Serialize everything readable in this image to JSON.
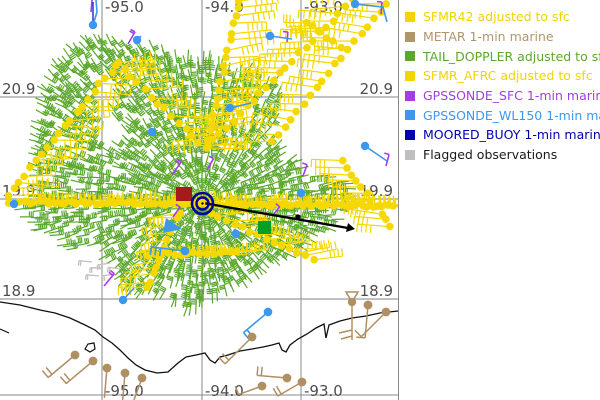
{
  "map": {
    "width": 398,
    "height": 400,
    "grid_color": "#9c9c9c",
    "border_color": "#8a8a8a",
    "label_color": "#4d4d4d",
    "coast_color": "#111111",
    "lon_lines": [
      {
        "label": "-95.0",
        "x": 102
      },
      {
        "label": "-94.0",
        "x": 202
      },
      {
        "label": "-93.0",
        "x": 301
      }
    ],
    "lat_lines": [
      {
        "label": "20.9",
        "y": 97
      },
      {
        "label": "19.9",
        "y": 199
      },
      {
        "label": "18.9",
        "y": 299
      }
    ],
    "coastline": [
      [
        0,
        302
      ],
      [
        20,
        305
      ],
      [
        40,
        310
      ],
      [
        55,
        313
      ],
      [
        70,
        318
      ],
      [
        85,
        325
      ],
      [
        95,
        330
      ],
      [
        103,
        337
      ],
      [
        112,
        343
      ],
      [
        120,
        350
      ],
      [
        128,
        358
      ],
      [
        136,
        365
      ],
      [
        145,
        370
      ],
      [
        157,
        373
      ],
      [
        168,
        372
      ],
      [
        178,
        363
      ],
      [
        186,
        357
      ],
      [
        196,
        355
      ],
      [
        205,
        353
      ],
      [
        210,
        360
      ],
      [
        215,
        363
      ],
      [
        220,
        357
      ],
      [
        228,
        355
      ],
      [
        240,
        351
      ],
      [
        252,
        349
      ],
      [
        263,
        347
      ],
      [
        272,
        345
      ],
      [
        279,
        343
      ],
      [
        282,
        350
      ],
      [
        286,
        352
      ],
      [
        290,
        345
      ],
      [
        298,
        339
      ],
      [
        307,
        334
      ],
      [
        316,
        328
      ],
      [
        324,
        324
      ],
      [
        326,
        338
      ],
      [
        329,
        325
      ],
      [
        340,
        321
      ],
      [
        352,
        318
      ],
      [
        366,
        316
      ],
      [
        380,
        313
      ],
      [
        398,
        311
      ]
    ],
    "island": [
      [
        85,
        349
      ],
      [
        88,
        344
      ],
      [
        94,
        343
      ],
      [
        95,
        349
      ],
      [
        90,
        352
      ]
    ],
    "coast_fragment": [
      [
        0,
        329
      ],
      [
        9,
        333
      ]
    ]
  },
  "legend": {
    "entries": [
      {
        "name": "sfmr42",
        "label": "SFMR42 adjusted to sfc",
        "color": "#f2d400"
      },
      {
        "name": "metar",
        "label": "METAR 1-min marine",
        "color": "#b0976b"
      },
      {
        "name": "tail-doppler",
        "label": "TAIL_DOPPLER adjusted to sfc",
        "color": "#5ba82c"
      },
      {
        "name": "sfmr-afrc",
        "label": "SFMR_AFRC adjusted to sfc",
        "color": "#f2d400"
      },
      {
        "name": "gpssonde-sfc",
        "label": "GPSSONDE_SFC 1-min marine",
        "color": "#a43ce8"
      },
      {
        "name": "gpssonde-wl150",
        "label": "GPSSONDE_WL150 1-min marine",
        "color": "#3d97ee"
      },
      {
        "name": "moored-buoy",
        "label": "MOORED_BUOY 1-min marine",
        "color": "#0000b0"
      },
      {
        "name": "flagged",
        "label": "Flagged observations",
        "color": "#bfbfbf",
        "text_color": "#1a1a1a"
      }
    ]
  },
  "storm": {
    "center": {
      "x": 202.5,
      "y": 203.5
    },
    "ring_color": "#0000a0",
    "outer_r": 10.5,
    "inner_r": 6,
    "center_dot_color": "#ffd900",
    "red_square": {
      "x": 176,
      "y": 187,
      "w": 16,
      "h": 14,
      "color": "#a51b1b"
    },
    "green_square": {
      "x": 258,
      "y": 221,
      "w": 13,
      "h": 13,
      "color": "#00a028"
    },
    "track": {
      "pts": [
        [
          203,
          203
        ],
        [
          348,
          228
        ]
      ],
      "mid_dot": [
        298,
        217
      ],
      "color": "#000000"
    }
  },
  "observations": {
    "colors": {
      "sfmr": "#f5d800",
      "tail_doppler": "#5ba82c",
      "metar": "#b08f63",
      "wl150": "#3d97ee",
      "sfc": "#a43ce8",
      "flagged": "#c0c0c0",
      "stem": "#3347bb"
    },
    "tail_doppler": {
      "spacing": 7,
      "polygon": [
        [
          33,
          95
        ],
        [
          45,
          68
        ],
        [
          58,
          48
        ],
        [
          75,
          36
        ],
        [
          100,
          32
        ],
        [
          125,
          38
        ],
        [
          148,
          37
        ],
        [
          172,
          48
        ],
        [
          195,
          50
        ],
        [
          214,
          50
        ],
        [
          232,
          55
        ],
        [
          243,
          66
        ],
        [
          252,
          60
        ],
        [
          268,
          64
        ],
        [
          280,
          76
        ],
        [
          287,
          92
        ],
        [
          282,
          106
        ],
        [
          278,
          122
        ],
        [
          287,
          138
        ],
        [
          298,
          152
        ],
        [
          305,
          163
        ],
        [
          313,
          170
        ],
        [
          338,
          175
        ],
        [
          357,
          181
        ],
        [
          365,
          193
        ],
        [
          366,
          205
        ],
        [
          355,
          215
        ],
        [
          344,
          224
        ],
        [
          331,
          237
        ],
        [
          314,
          248
        ],
        [
          297,
          259
        ],
        [
          278,
          271
        ],
        [
          258,
          283
        ],
        [
          239,
          292
        ],
        [
          225,
          299
        ],
        [
          211,
          310
        ],
        [
          197,
          320
        ],
        [
          182,
          322
        ],
        [
          167,
          311
        ],
        [
          151,
          303
        ],
        [
          135,
          300
        ],
        [
          121,
          295
        ],
        [
          111,
          282
        ],
        [
          99,
          262
        ],
        [
          89,
          246
        ],
        [
          69,
          252
        ],
        [
          47,
          243
        ],
        [
          27,
          228
        ],
        [
          13,
          214
        ],
        [
          14,
          204
        ],
        [
          22,
          196
        ],
        [
          28,
          184
        ],
        [
          26,
          160
        ],
        [
          28,
          130
        ],
        [
          30,
          110
        ]
      ],
      "holes": [
        {
          "cx": 97,
          "cy": 100,
          "rx": 10,
          "ry": 40
        },
        {
          "cx": 101,
          "cy": 128,
          "rx": 15,
          "ry": 16
        },
        {
          "cx": 247,
          "cy": 103,
          "rx": 11,
          "ry": 13
        }
      ]
    },
    "sfmr_legs": [
      {
        "from": [
          117,
          64
        ],
        "to": [
          8,
          196
        ],
        "spacing": 9,
        "a": 0,
        "len": 36,
        "ticks": 5,
        "tickdir": -1
      },
      {
        "from": [
          117,
          64
        ],
        "to": [
          206,
          148
        ],
        "spacing": 9,
        "a": 0,
        "len": 36,
        "ticks": 5,
        "tickdir": -1
      },
      {
        "from": [
          239,
          0
        ],
        "to": [
          207,
          147
        ],
        "spacing": 8,
        "a": -8,
        "len": 38,
        "ticks": 5,
        "tickdir": 1
      },
      {
        "from": [
          207,
          147
        ],
        "to": [
          352,
          0
        ],
        "spacing": 9,
        "a": 180,
        "len": 36,
        "ticks": 5,
        "tickdir": -1
      },
      {
        "from": [
          387,
          3
        ],
        "to": [
          272,
          142
        ],
        "spacing": 10,
        "a": 185,
        "len": 34,
        "ticks": 4,
        "tickdir": -1
      },
      {
        "from": [
          10,
          202
        ],
        "to": [
          393,
          206
        ],
        "spacing": 5,
        "a": -3,
        "len": 34,
        "ticks": 4,
        "tickdir": -1
      },
      {
        "from": [
          180,
          212
        ],
        "to": [
          147,
          288
        ],
        "spacing": 7,
        "a": 175,
        "len": 30,
        "ticks": 4,
        "tickdir": -1
      },
      {
        "from": [
          149,
          255
        ],
        "to": [
          238,
          252
        ],
        "spacing": 6,
        "a": 0,
        "len": 30,
        "ticks": 4,
        "tickdir": -1
      },
      {
        "from": [
          211,
          214
        ],
        "to": [
          313,
          259
        ],
        "spacing": 8,
        "a": -5,
        "len": 32,
        "ticks": 4,
        "tickdir": -1
      },
      {
        "from": [
          342,
          162
        ],
        "to": [
          391,
          227
        ],
        "spacing": 8,
        "a": 185,
        "len": 30,
        "ticks": 4,
        "tickdir": -1
      },
      {
        "from": [
          306,
          22
        ],
        "to": [
          340,
          47
        ],
        "spacing": 8,
        "a": 180,
        "len": 26,
        "ticks": 3,
        "tickdir": 1
      }
    ],
    "metar": [
      {
        "x": 75,
        "y": 355,
        "a": 140,
        "len": 35,
        "ticks": 2
      },
      {
        "x": 93,
        "y": 361,
        "a": 140,
        "len": 35,
        "ticks": 2
      },
      {
        "x": 107,
        "y": 368,
        "a": 95,
        "len": 30,
        "ticks": 0
      },
      {
        "x": 125,
        "y": 373,
        "a": 95,
        "len": 28,
        "ticks": 0
      },
      {
        "x": 142,
        "y": 378,
        "a": 110,
        "len": 28,
        "ticks": 1
      },
      {
        "x": 252,
        "y": 337,
        "a": 135,
        "len": 38,
        "ticks": 2
      },
      {
        "x": 287,
        "y": 378,
        "a": 185,
        "len": 30,
        "ticks": 2
      },
      {
        "x": 302,
        "y": 382,
        "a": 150,
        "len": 28,
        "ticks": 2
      },
      {
        "x": 368,
        "y": 305,
        "a": 95,
        "len": 33,
        "ticks": 1
      },
      {
        "x": 386,
        "y": 312,
        "a": 135,
        "len": 35,
        "ticks": 1
      },
      {
        "x": 262,
        "y": 386,
        "a": 160,
        "len": 25,
        "ticks": 1
      }
    ],
    "metar_flag_barb": {
      "x": 352,
      "y": 302
    },
    "wl150_dots": [
      [
        93,
        25
      ],
      [
        270,
        36
      ],
      [
        355,
        4
      ],
      [
        230,
        108
      ],
      [
        152,
        132
      ],
      [
        365,
        146
      ],
      [
        14,
        204
      ],
      [
        236,
        234
      ],
      [
        185,
        251
      ],
      [
        123,
        300
      ],
      [
        268,
        312
      ],
      [
        301,
        193
      ],
      [
        137,
        40
      ]
    ],
    "wl150_lines": [
      [
        [
          93,
          25
        ],
        [
          97,
          12
        ],
        [
          96,
          0
        ]
      ],
      [
        [
          270,
          36
        ],
        [
          292,
          39
        ]
      ],
      [
        [
          355,
          4
        ],
        [
          383,
          7
        ],
        [
          387,
          22
        ]
      ],
      [
        [
          230,
          108
        ],
        [
          251,
          103
        ]
      ],
      [
        [
          365,
          146
        ],
        [
          387,
          161
        ]
      ],
      [
        [
          123,
          300
        ],
        [
          134,
          288
        ]
      ],
      [
        [
          135,
          44
        ],
        [
          141,
          36
        ]
      ]
    ],
    "wl150_stem": [
      [
        93,
        25
      ],
      [
        93,
        2
      ]
    ],
    "wl150_barbs": [
      {
        "x": 185,
        "y": 251,
        "a": 187,
        "len": 34,
        "ticks": 3
      },
      {
        "x": 268,
        "y": 312,
        "a": 140,
        "len": 32,
        "ticks": 2
      }
    ],
    "wl150_patch": [
      [
        163,
        233
      ],
      [
        166,
        218
      ],
      [
        182,
        229
      ]
    ],
    "sfc_barbs": [
      {
        "x": 172,
        "y": 175,
        "a": -55,
        "len": 16,
        "ticks": 2
      },
      {
        "x": 104,
        "y": 286,
        "a": -50,
        "len": 16,
        "ticks": 2
      },
      {
        "x": 207,
        "y": 170,
        "a": -60,
        "len": 13,
        "ticks": 1
      },
      {
        "x": 303,
        "y": 176,
        "a": -70,
        "len": 12,
        "ticks": 1
      },
      {
        "x": 272,
        "y": 216,
        "a": -50,
        "len": 12,
        "ticks": 1
      },
      {
        "x": 386,
        "y": 166,
        "a": -75,
        "len": 12,
        "ticks": 1
      },
      {
        "x": 91,
        "y": 12,
        "a": -85,
        "len": 22,
        "ticks": 0
      },
      {
        "x": 381,
        "y": 14,
        "a": -85,
        "len": 12,
        "ticks": 1
      },
      {
        "x": 287,
        "y": 42,
        "a": -85,
        "len": 10,
        "ticks": 1
      },
      {
        "x": 173,
        "y": 217,
        "a": -55,
        "len": 12,
        "ticks": 1
      },
      {
        "x": 128,
        "y": 44,
        "a": -60,
        "len": 14,
        "ticks": 2
      }
    ],
    "flagged": [
      {
        "x": 92,
        "y": 262
      },
      {
        "x": 103,
        "y": 268
      },
      {
        "x": 115,
        "y": 274
      },
      {
        "x": 99,
        "y": 276
      },
      {
        "x": 110,
        "y": 263
      },
      {
        "x": 121,
        "y": 269
      }
    ]
  }
}
